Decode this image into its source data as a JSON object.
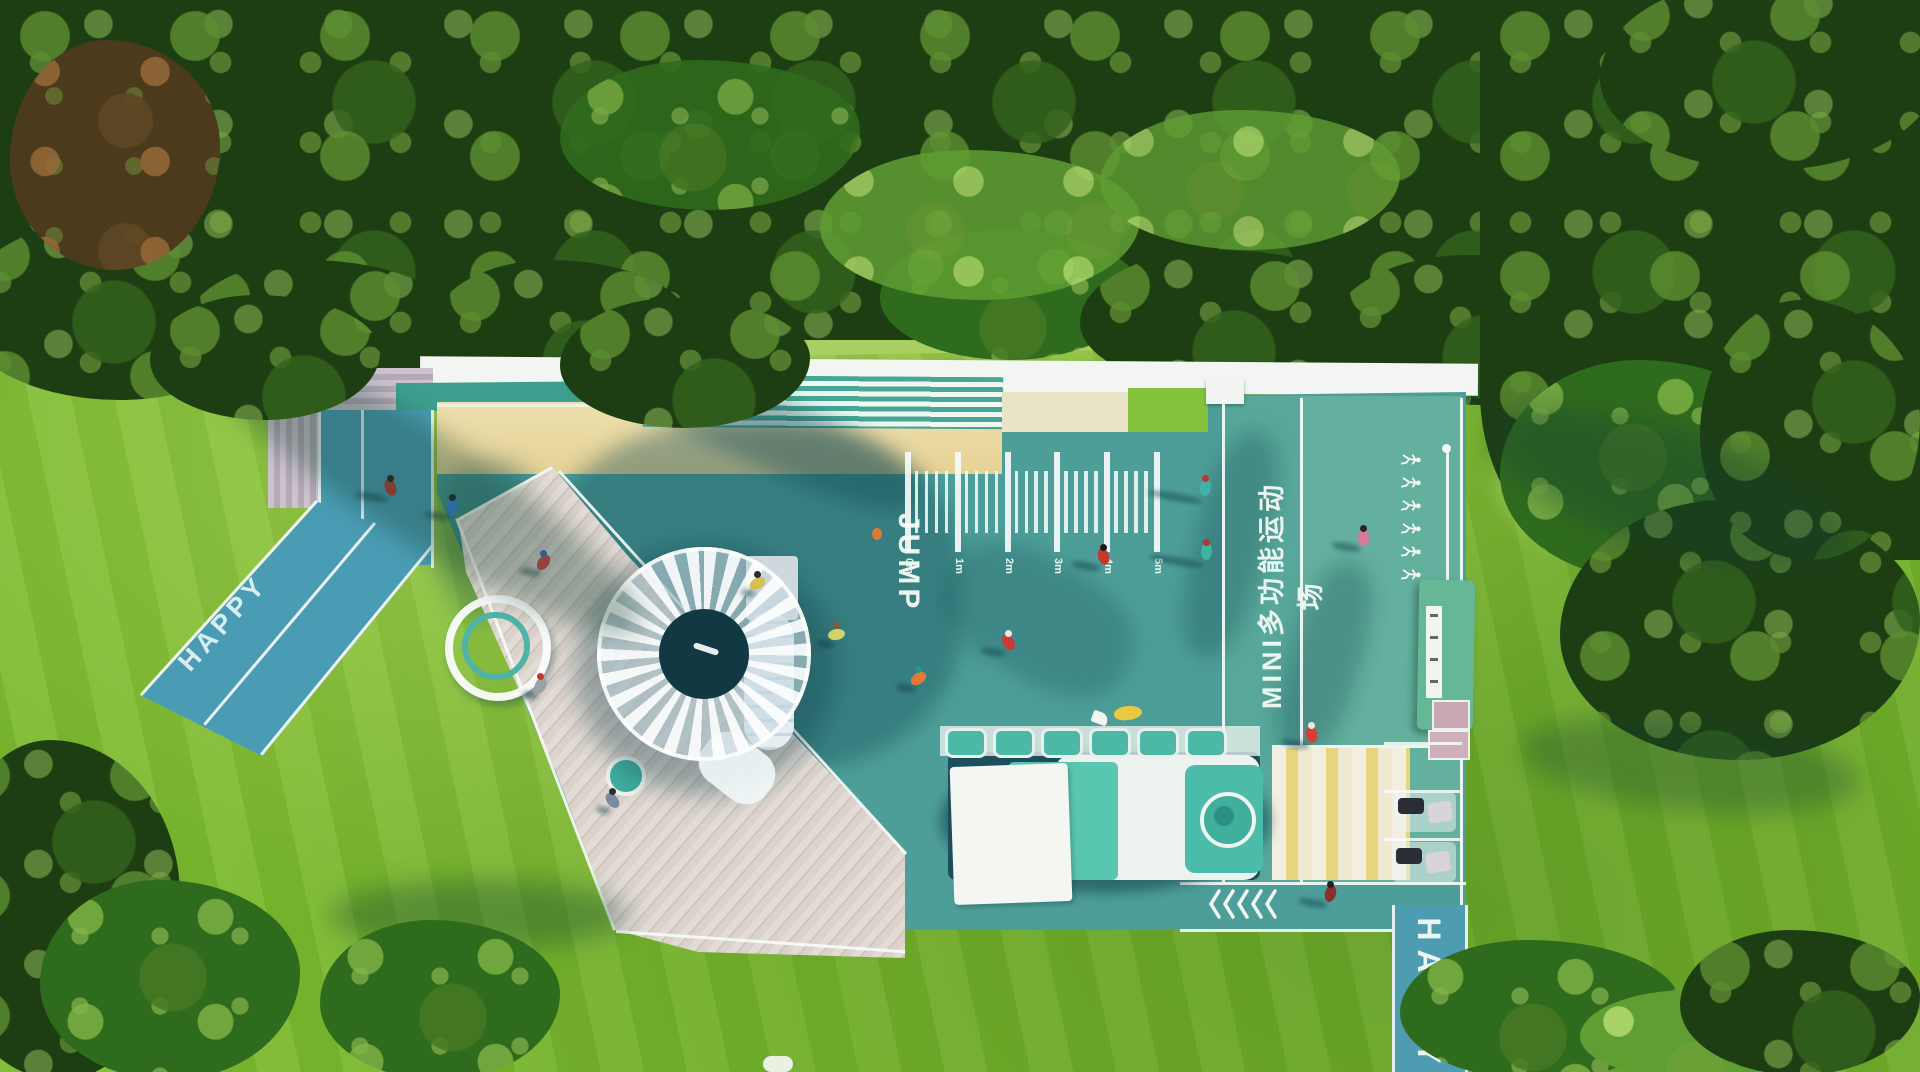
{
  "labels": {
    "happy_path_left": "HAPPY",
    "jump_lane": "JUMP",
    "court_lane": "MINI多功能运动场",
    "happy_path_exit": "HAPPY"
  },
  "jump_ruler": {
    "unit_labels": [
      "0m",
      "1m",
      "2m",
      "3m",
      "4m",
      "5m"
    ],
    "minor_ticks_between": 4
  },
  "ground_icons": {
    "chevrons": {
      "name": "chevron-left-icon",
      "count": 5
    },
    "fitness_figures": {
      "name": "runner-icon",
      "count": 6
    }
  },
  "palette": {
    "court_teal": "#4d9e99",
    "lane_light": "#64b09e",
    "path_blue": "#4a9cb4",
    "sand": "#ead9a2",
    "deck": "#d8cfc6",
    "train_mint": "#57c3ad",
    "marking_white": "#f3f8f5",
    "lawn_green": "#7cba2f",
    "forest_dark": "#1d3e12"
  },
  "people": [
    {
      "x": 390,
      "y": 487,
      "shirt": "#c0392f",
      "head": "#2b2420",
      "rot": -20,
      "sh": 34
    },
    {
      "x": 452,
      "y": 506,
      "shirt": "#3a7fd5",
      "head": "#23262e",
      "rot": 10,
      "sh": 26
    },
    {
      "x": 543,
      "y": 562,
      "shirt": "#d64545",
      "head": "#3b6fd0",
      "rot": 35,
      "sh": 22
    },
    {
      "x": 836,
      "y": 634,
      "shirt": "#cfd46a",
      "head": "#8a5a30",
      "rot": 80,
      "sh": 18
    },
    {
      "x": 1103,
      "y": 556,
      "shirt": "#c23a2c",
      "head": "#1f1b18",
      "rot": -15,
      "sh": 30
    },
    {
      "x": 918,
      "y": 678,
      "shirt": "#e07a35",
      "head": "#2f9486",
      "rot": 55,
      "sh": 20
    },
    {
      "x": 1008,
      "y": 642,
      "shirt": "#cc3a35",
      "head": "#efe9df",
      "rot": -30,
      "sh": 26
    },
    {
      "x": 1205,
      "y": 487,
      "shirt": "#3fb3a4",
      "head": "#c03328",
      "rot": 5,
      "sh": 56
    },
    {
      "x": 1206,
      "y": 551,
      "shirt": "#3fb3a4",
      "head": "#c03328",
      "rot": 5,
      "sh": 56
    },
    {
      "x": 1363,
      "y": 537,
      "shirt": "#d87a9a",
      "head": "#2c2622",
      "rot": 0,
      "sh": 30
    },
    {
      "x": 1311,
      "y": 734,
      "shirt": "#d04034",
      "head": "#ece6dc",
      "rot": -10,
      "sh": 28
    },
    {
      "x": 1330,
      "y": 893,
      "shirt": "#8a2f2a",
      "head": "#23201e",
      "rot": 15,
      "sh": 30
    },
    {
      "x": 540,
      "y": 685,
      "shirt": "#9aa0a8",
      "head": "#c23a30",
      "rot": 25,
      "sh": 16
    },
    {
      "x": 612,
      "y": 800,
      "shirt": "#7a8aa0",
      "head": "#2a2e36",
      "rot": -40,
      "sh": 14
    },
    {
      "x": 757,
      "y": 583,
      "shirt": "#d8c050",
      "head": "#2a2a2a",
      "rot": 60,
      "sh": 14
    }
  ]
}
